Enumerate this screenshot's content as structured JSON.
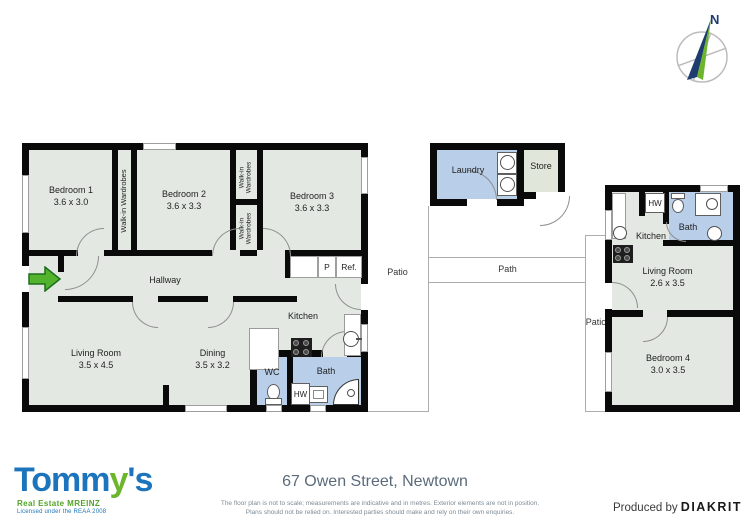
{
  "compass": {
    "north_label": "N"
  },
  "labels": {
    "walkin_long": "Walk-in Wardrobes",
    "walkin_l1": "Walk-in",
    "walkin_l2": "Wardrobes",
    "hallway": "Hallway",
    "kitchen": "Kitchen",
    "wc": "WC",
    "bath": "Bath",
    "hw": "HW",
    "pantry": "P",
    "fridge": "Ref.",
    "laundry": "Laundry",
    "store": "Store",
    "patio": "Patio",
    "path": "Path"
  },
  "rooms": {
    "bedroom1": {
      "name": "Bedroom 1",
      "dims": "3.6 x 3.0"
    },
    "bedroom2": {
      "name": "Bedroom 2",
      "dims": "3.6 x 3.3"
    },
    "bedroom3": {
      "name": "Bedroom 3",
      "dims": "3.6 x 3.3"
    },
    "living_main": {
      "name": "Living Room",
      "dims": "3.5 x 4.5"
    },
    "dining": {
      "name": "Dining",
      "dims": "3.5 x 3.2"
    },
    "living_unit": {
      "name": "Living Room",
      "dims": "2.6 x 3.5"
    },
    "bedroom4": {
      "name": "Bedroom 4",
      "dims": "3.0 x 3.5"
    }
  },
  "footer": {
    "brand": "Tomm",
    "brand_y": "y",
    "brand_s": "'s",
    "brand_sub": "Real Estate MREINZ",
    "brand_license": "Licensed under the REAA 2008",
    "address": "67 Owen Street, Newtown",
    "disclaimer1": "The floor plan is not to scale; measurements are indicative and in metres. Exterior elements are not in position.",
    "disclaimer2": "Plans should not be relied on. Interested parties should make and rely on their own enquiries.",
    "produced_by": "Produced by",
    "producer": "DIAKRIT"
  },
  "colors": {
    "wall": "#0a0a0a",
    "room_fill": "#e3e9e2",
    "wet_fill": "#b9cfe9",
    "store_fill": "#e0e7da",
    "logo_blue": "#1b74bc",
    "logo_green": "#6cb52d",
    "compass_navy": "#1e3c6e",
    "compass_green": "#6cb52d",
    "entry_arrow_green": "#53b32c",
    "address_text": "#5b6b7b"
  }
}
